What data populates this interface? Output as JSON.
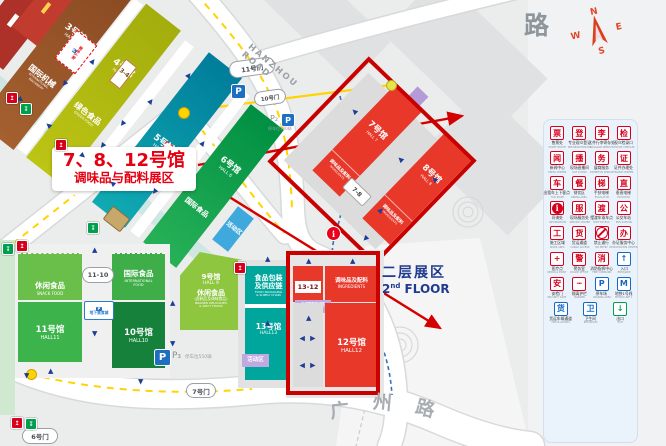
{
  "compass": {
    "n": "N",
    "e": "E",
    "s": "S",
    "w": "W"
  },
  "roads": {
    "top_partial": "路",
    "hanzhou": "HANZHOU ROAD",
    "guangzhou_chars": [
      "广",
      "州",
      "路"
    ]
  },
  "floor2": {
    "zh": "二层展区",
    "num": "2",
    "sup": "nd",
    "word": "FLOOR"
  },
  "annotation": {
    "line1": "7、8、12号馆",
    "line2": "调味品与配料展区"
  },
  "gates": {
    "g3_4": "3-4",
    "g6": "6号门",
    "g7": "7号门",
    "g10": "10号门",
    "g11": "11号门",
    "g7_8": "7-8",
    "g11_10": "11-10",
    "g13_12": "13-12"
  },
  "halls": {
    "hall3": {
      "no": "3号馆",
      "en": "HALL 3",
      "cat_zh": "国际机械",
      "cat_en1": "INTERNATIONAL",
      "cat_en2": "MACHINERY"
    },
    "hall4": {
      "no": "4号馆",
      "en": "HALL 4",
      "cat_zh": "绿色食品",
      "cat_en": "GREEN FOOD"
    },
    "hall5": {
      "no": "5号馆",
      "en": "HALL 5"
    },
    "hall6": {
      "no": "6号馆",
      "en": "HALL 6",
      "cat_zh": "国际食品"
    },
    "hall7": {
      "no": "7号馆",
      "en": "HALL 7",
      "strip_zh": "调味品及配料",
      "strip_en": "INGREDIENTS"
    },
    "hall8": {
      "no": "8号馆",
      "en": "HALL 8",
      "strip_zh": "调味品及配料",
      "strip_en": "INGREDIENTS"
    },
    "hall9": {
      "no": "9号馆",
      "en": "HALL 9",
      "cat_zh": "休闲食品",
      "cat_sub": "(卤制品及调味食品)",
      "cat_en1": "BRAISED DELICACIES",
      "cat_en2": "& SPICY FOODS"
    },
    "hall10": {
      "no": "10号馆",
      "en": "HALL10",
      "cat_zh": "国际食品",
      "cat_en1": "INTERNATIONAL",
      "cat_en2": "FOOD"
    },
    "hall11": {
      "no": "11号馆",
      "en": "HALL11",
      "cat_zh": "休闲食品",
      "cat_en": "SNACK FOOD"
    },
    "hall12": {
      "no": "12号馆",
      "en": "HALL12",
      "strip_zh": "调味品及配料",
      "strip_en": "INGREDIENTS"
    },
    "hall13": {
      "no": "13号馆",
      "en": "HALL13",
      "cat_zh1": "食品包装",
      "cat_zh2": "及供应链",
      "cat_en1": "FOOD PACKAGING",
      "cat_en2": "& SUPPLY CHAIN"
    }
  },
  "areas": {
    "conference_zh": "会议赛事活动区",
    "conference_en": "CONFERENCE ACTIVITIES AREA",
    "activities_zh": "会议赛事活动区",
    "activities_en": "ACTIVITIES AREA",
    "activity_area": "活动区",
    "activity_area_blue": "活动区",
    "underground_garage": "地下车库",
    "underground_food": "地下美食城"
  },
  "parking": {
    "p_icon": "P",
    "p2_label": "P₂",
    "p2_note": "停车位180辆",
    "p3_label": "P₃",
    "p3_note": "停车位550辆"
  },
  "info_marker": "i",
  "legend": {
    "items": [
      {
        "zh": "售票处",
        "en": "TICKET BOOTH",
        "type": "char",
        "glyph": "票",
        "tone": "red"
      },
      {
        "zh": "专业观众登记",
        "en": "PRE-REGISTRATION",
        "type": "char",
        "glyph": "登",
        "tone": "red"
      },
      {
        "zh": "大件行李寄存处",
        "en": "BAGGAGE DEPOSIT",
        "type": "char",
        "glyph": "李",
        "tone": "red"
      },
      {
        "zh": "观众检录口",
        "en": "VISITOR CHECK-IN",
        "type": "char",
        "glyph": "检",
        "tone": "red"
      },
      {
        "zh": "新闻中心",
        "en": "PRESS CENTER",
        "type": "char",
        "glyph": "闻",
        "tone": "red"
      },
      {
        "zh": "现场直播间",
        "en": "LIVE STUDIO",
        "type": "char",
        "glyph": "播",
        "tone": "red"
      },
      {
        "zh": "展商服务",
        "en": "EXHIBITOR SERVICE",
        "type": "char",
        "glyph": "务",
        "tone": "red"
      },
      {
        "zh": "证件办理处",
        "en": "BADGE CENTER",
        "type": "char",
        "glyph": "证",
        "tone": "red"
      },
      {
        "zh": "出租车上下客点",
        "en": "TAXI POINT",
        "type": "char",
        "glyph": "车",
        "tone": "red"
      },
      {
        "zh": "餐饮区",
        "en": "DINING AREA",
        "type": "char",
        "glyph": "餐",
        "tone": "red"
      },
      {
        "zh": "手扶电梯",
        "en": "ESCALATOR",
        "type": "char",
        "glyph": "梯",
        "tone": "red"
      },
      {
        "zh": "垂直电梯",
        "en": "ELEVATOR",
        "type": "char",
        "glyph": "直",
        "tone": "red"
      },
      {
        "zh": "问询处",
        "en": "INFORMATION",
        "type": "info",
        "glyph": "i",
        "tone": "red"
      },
      {
        "zh": "现场服务处",
        "en": "SERVICE CENTER",
        "type": "char",
        "glyph": "服",
        "tone": "red"
      },
      {
        "zh": "摆渡车乘车点",
        "en": "SHUTTLE BUS",
        "type": "char",
        "glyph": "渡",
        "tone": "red"
      },
      {
        "zh": "公交车站",
        "en": "BUS STATION",
        "type": "char",
        "glyph": "公",
        "tone": "red"
      },
      {
        "zh": "施工区域",
        "en": "WORK AREA",
        "type": "char",
        "glyph": "工",
        "tone": "red"
      },
      {
        "zh": "货运通道",
        "en": "CARGO ACCESS",
        "type": "char",
        "glyph": "货",
        "tone": "red"
      },
      {
        "zh": "禁止通行",
        "en": "NO ENTRY",
        "type": "noentry",
        "glyph": "",
        "tone": "red"
      },
      {
        "zh": "办证服务中心",
        "en": "REGISTRATION CENTER",
        "type": "char",
        "glyph": "办",
        "tone": "red"
      },
      {
        "zh": "医疗点",
        "en": "MEDICAL POINT",
        "type": "char",
        "glyph": "+",
        "tone": "red"
      },
      {
        "zh": "警务室",
        "en": "POLICE OFFICE",
        "type": "char",
        "glyph": "警",
        "tone": "red"
      },
      {
        "zh": "消防指挥中心",
        "en": "FIRE COMMAND",
        "type": "char",
        "glyph": "消",
        "tone": "red"
      },
      {
        "zh": "入口",
        "en": "ENTRANCE",
        "type": "char",
        "glyph": "↑",
        "tone": "blue"
      },
      {
        "zh": "安检门",
        "en": "SECURITY GATE",
        "type": "char",
        "glyph": "安",
        "tone": "red"
      },
      {
        "zh": "隔离护栏",
        "en": "BARRIER",
        "type": "char",
        "glyph": "┅",
        "tone": "red"
      },
      {
        "zh": "停车场",
        "en": "PARKING AREA",
        "type": "char",
        "glyph": "P",
        "tone": "blue"
      },
      {
        "zh": "地铁1号线",
        "en": "METRO LINE 1",
        "type": "char",
        "glyph": "M",
        "tone": "blue"
      },
      {
        "zh": "货运车辆通道",
        "en": "TRUCK ACCESS",
        "type": "char",
        "glyph": "货",
        "tone": "blue"
      },
      {
        "zh": "卫生间",
        "en": "RESTROOM",
        "type": "char",
        "glyph": "卫",
        "tone": "blue"
      },
      {
        "zh": "出口",
        "en": "EXIT",
        "type": "char",
        "glyph": "↓",
        "tone": "green"
      }
    ]
  },
  "colors": {
    "highlight_red": "#e60012",
    "frame_red": "#c90000",
    "hall_red": "#e8382a",
    "hall3": "#9c5a2e",
    "hall4": "#b9c21a",
    "hall5": "#0aa0ac",
    "hall6": "#0aa14e",
    "hall9": "#8ec63f",
    "hall10": "#15813b",
    "hall11": "#3cb44b",
    "hall13": "#00a69c",
    "lavender": "#c0a9e0",
    "blue_arrow": "#1c3e96",
    "floor2_blue": "#1f3a8f"
  }
}
